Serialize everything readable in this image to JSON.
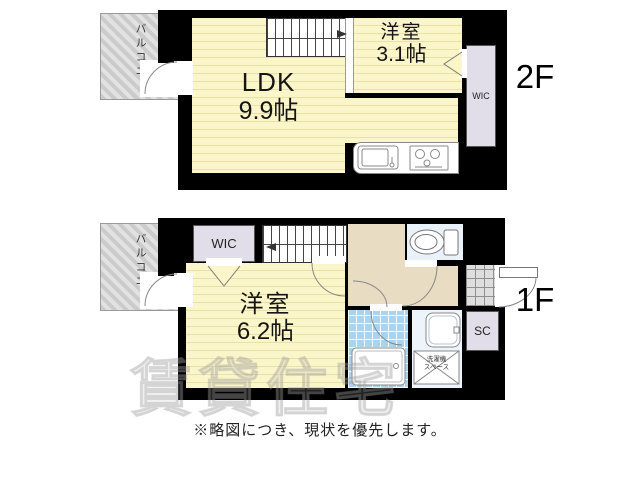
{
  "floor2": {
    "label": "2F",
    "balcony": "バルコニー",
    "ldk": {
      "name": "LDK",
      "size": "9.9帖"
    },
    "room": {
      "name": "洋室",
      "size": "3.1帖"
    },
    "wic": "WIC"
  },
  "floor1": {
    "label": "1F",
    "balcony": "バルコニー",
    "wic": "WIC",
    "room": {
      "name": "洋室",
      "size": "6.2帖"
    },
    "sc": "SC",
    "laundry": {
      "line1": "洗濯機",
      "line2": "スペース"
    }
  },
  "note": "※略図につき、現状を優先します。",
  "watermark": "賃貸住宅",
  "colors": {
    "wall": "#000000",
    "room_floor": "#FBF5CA",
    "room_floor_stripe": "#EADFA7",
    "hallway": "#E8DCC2",
    "closet": "#E2DEE9",
    "toilet_room": "#EAF2F9",
    "bath_tile": "#A9D4F0",
    "balcony": "#DADADA",
    "entrance_tile": "#DEDEDE"
  }
}
